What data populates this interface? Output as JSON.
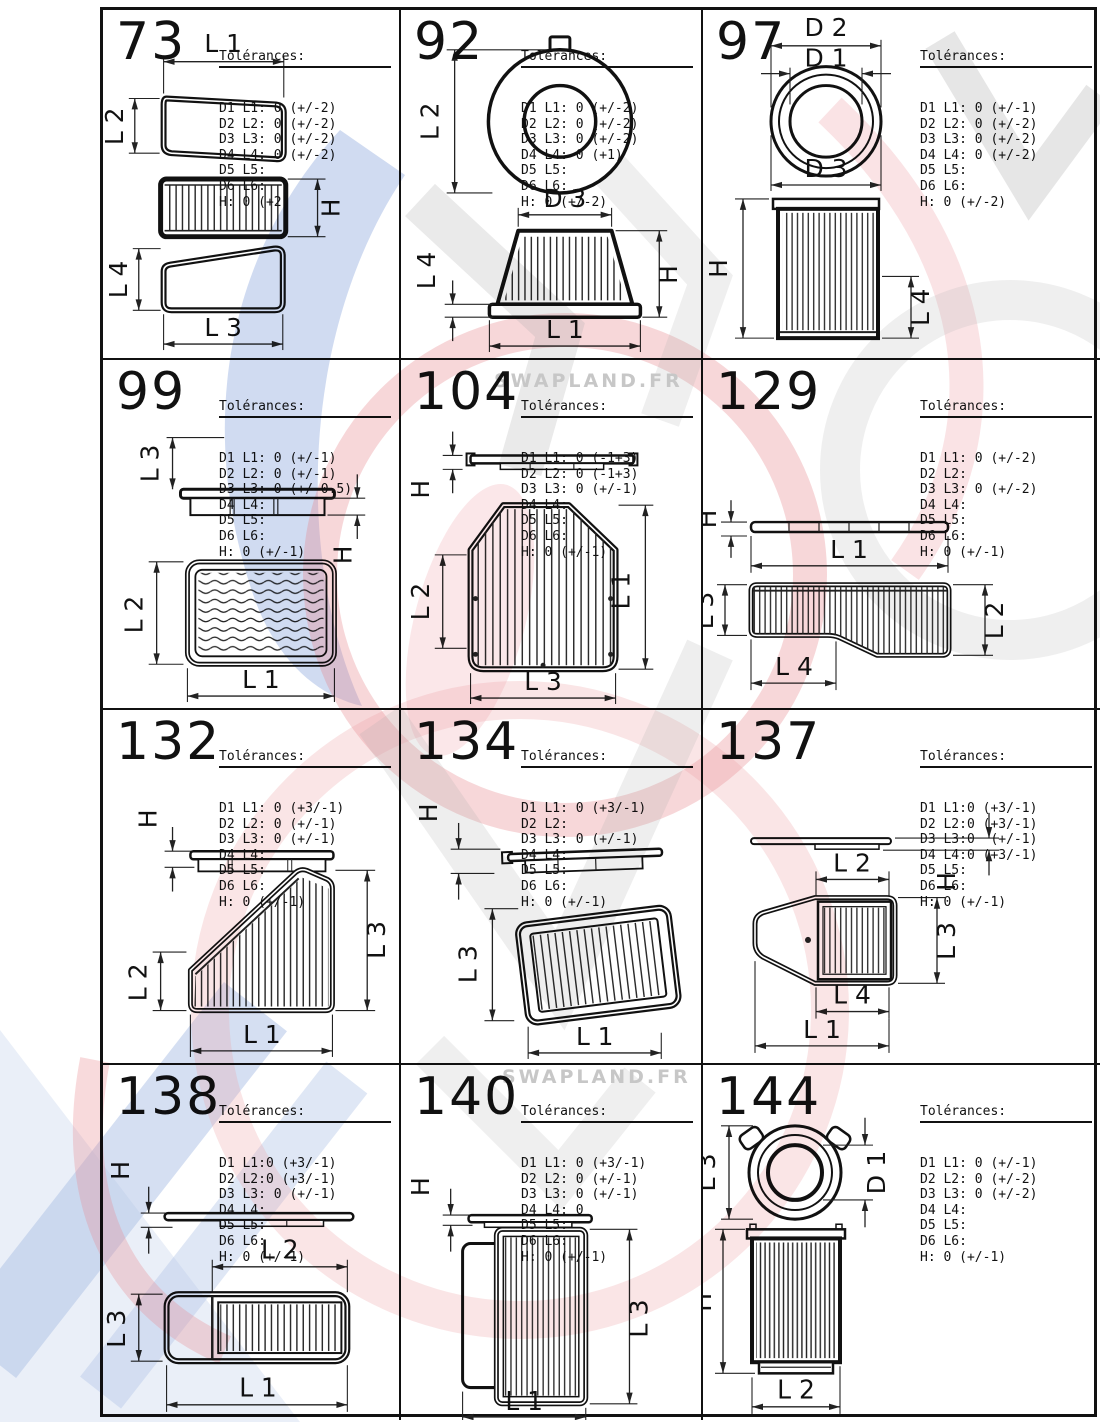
{
  "tol_title": "Tolérances:",
  "watermark": {
    "text": "SWAPLAND.FR"
  },
  "colors": {
    "paper": "#ffffff",
    "ink": "#111111",
    "watermark_red": "#e8858c",
    "watermark_blue": "#6c8fd4",
    "watermark_gray": "#a8a8a8"
  },
  "cells": [
    {
      "num": "73",
      "tol": [
        "D1 L1: 0 (+/-2)",
        "D2 L2: 0 (+/-2)",
        "D3 L3: 0 (+/-2)",
        "D4 L4: 0 (+/-2)",
        "D5 L5:",
        "D6 L6:",
        "H: 0 (+2)"
      ],
      "labels": {
        "l1": "L 1",
        "l2": "L 2",
        "l3": "L 3",
        "l4": "L 4",
        "h": "H"
      }
    },
    {
      "num": "92",
      "tol": [
        "D1 L1: 0 (+/-2)",
        "D2 L2: 0 (+/-2)",
        "D3 L3: 0 (+/-2)",
        "D4 L4: 0 (+1)",
        "D5 L5:",
        "D6 L6:",
        "H: 0 (+/-2)"
      ],
      "labels": {
        "l1": "L 1",
        "l2": "L 2",
        "l4": "L 4",
        "d3": "D 3",
        "h": "H"
      }
    },
    {
      "num": "97",
      "tol": [
        "D1 L1: 0 (+/-1)",
        "D2 L2: 0 (+/-2)",
        "D3 L3: 0 (+/-2)",
        "D4 L4: 0 (+/-2)",
        "D5 L5:",
        "D6 L6:",
        "H: 0 (+/-2)"
      ],
      "labels": {
        "d1": "D 1",
        "d2": "D 2",
        "d3": "D 3",
        "l4": "L 4",
        "h": "H"
      }
    },
    {
      "num": "99",
      "tol": [
        "D1 L1: 0 (+/-1)",
        "D2 L2: 0 (+/-1)",
        "D3 L3: 0 (+/-0.5)",
        "D4 L4:",
        "D5 L5:",
        "D6 L6:",
        "H: 0 (+/-1)"
      ],
      "labels": {
        "l1": "L 1",
        "l2": "L 2",
        "l3": "L 3",
        "h": "H"
      }
    },
    {
      "num": "104",
      "tol": [
        "D1 L1: 0 (-1+3)",
        "D2 L2: 0 (-1+3)",
        "D3 L3: 0 (+/-1)",
        "D4 L4:",
        "D5 L5:",
        "D6 L6:",
        "H: 0 (+/-1)"
      ],
      "labels": {
        "l1": "L 1",
        "l2": "L 2",
        "l3": "L 3",
        "h": "H"
      }
    },
    {
      "num": "129",
      "tol": [
        "D1 L1: 0 (+/-2)",
        "D2 L2:",
        "D3 L3: 0 (+/-2)",
        "D4 L4:",
        "D5 L5:",
        "D6 L6:",
        "H: 0 (+/-1)"
      ],
      "labels": {
        "l1": "L 1",
        "l2": "L 2",
        "l3": "L 3",
        "l4": "L 4",
        "h": "H"
      }
    },
    {
      "num": "132",
      "tol": [
        "D1 L1: 0 (+3/-1)",
        "D2 L2: 0 (+/-1)",
        "D3 L3: 0 (+/-1)",
        "D4 L4:",
        "D5 L5:",
        "D6 L6:",
        "H: 0 (+/-1)"
      ],
      "labels": {
        "l1": "L 1",
        "l2": "L 2",
        "l3": "L 3",
        "h": "H"
      }
    },
    {
      "num": "134",
      "tol": [
        "D1 L1: 0 (+3/-1)",
        "D2 L2:",
        "D3 L3: 0 (+/-1)",
        "D4 L4:",
        "D5 L5:",
        "D6 L6:",
        "H: 0 (+/-1)"
      ],
      "labels": {
        "l1": "L 1",
        "l3": "L 3",
        "h": "H"
      }
    },
    {
      "num": "137",
      "tol": [
        "D1 L1:0 (+3/-1)",
        "D2 L2:0 (+3/-1)",
        "D3 L3:0  (+/-1)",
        "D4 L4:0 (+3/-1)",
        "D5 L5:",
        "D6 L6:",
        "H: 0 (+/-1)"
      ],
      "labels": {
        "l1": "L 1",
        "l2": "L 2",
        "l3": "L 3",
        "l4": "L 4",
        "h": "H"
      }
    },
    {
      "num": "138",
      "tol": [
        "D1 L1:0 (+3/-1)",
        "D2 L2:0 (+3/-1)",
        "D3 L3: 0 (+/-1)",
        "D4 L4:",
        "D5 L5:",
        "D6 L6:",
        "H: 0 (+/-1)"
      ],
      "labels": {
        "l1": "L 1",
        "l2": "L 2",
        "l3": "L 3",
        "h": "H"
      }
    },
    {
      "num": "140",
      "tol": [
        "D1 L1: 0 (+3/-1)",
        "D2 L2: 0 (+/-1)",
        "D3 L3: 0 (+/-1)",
        "D4 L4: 0",
        "D5 L5:",
        "D6 L6:",
        "H: 0 (+/-1)"
      ],
      "labels": {
        "l1": "L 1",
        "l2": "L 2",
        "l3": "L 3",
        "h": "H"
      }
    },
    {
      "num": "144",
      "tol": [
        "D1 L1: 0 (+/-1)",
        "D2 L2: 0 (+/-2)",
        "D3 L3: 0 (+/-2)",
        "D4 L4:",
        "D5 L5:",
        "D6 L6:",
        "H: 0 (+/-1)"
      ],
      "labels": {
        "l2": "L 2",
        "l3": "L 3",
        "d1": "D 1",
        "h": "H"
      }
    }
  ]
}
